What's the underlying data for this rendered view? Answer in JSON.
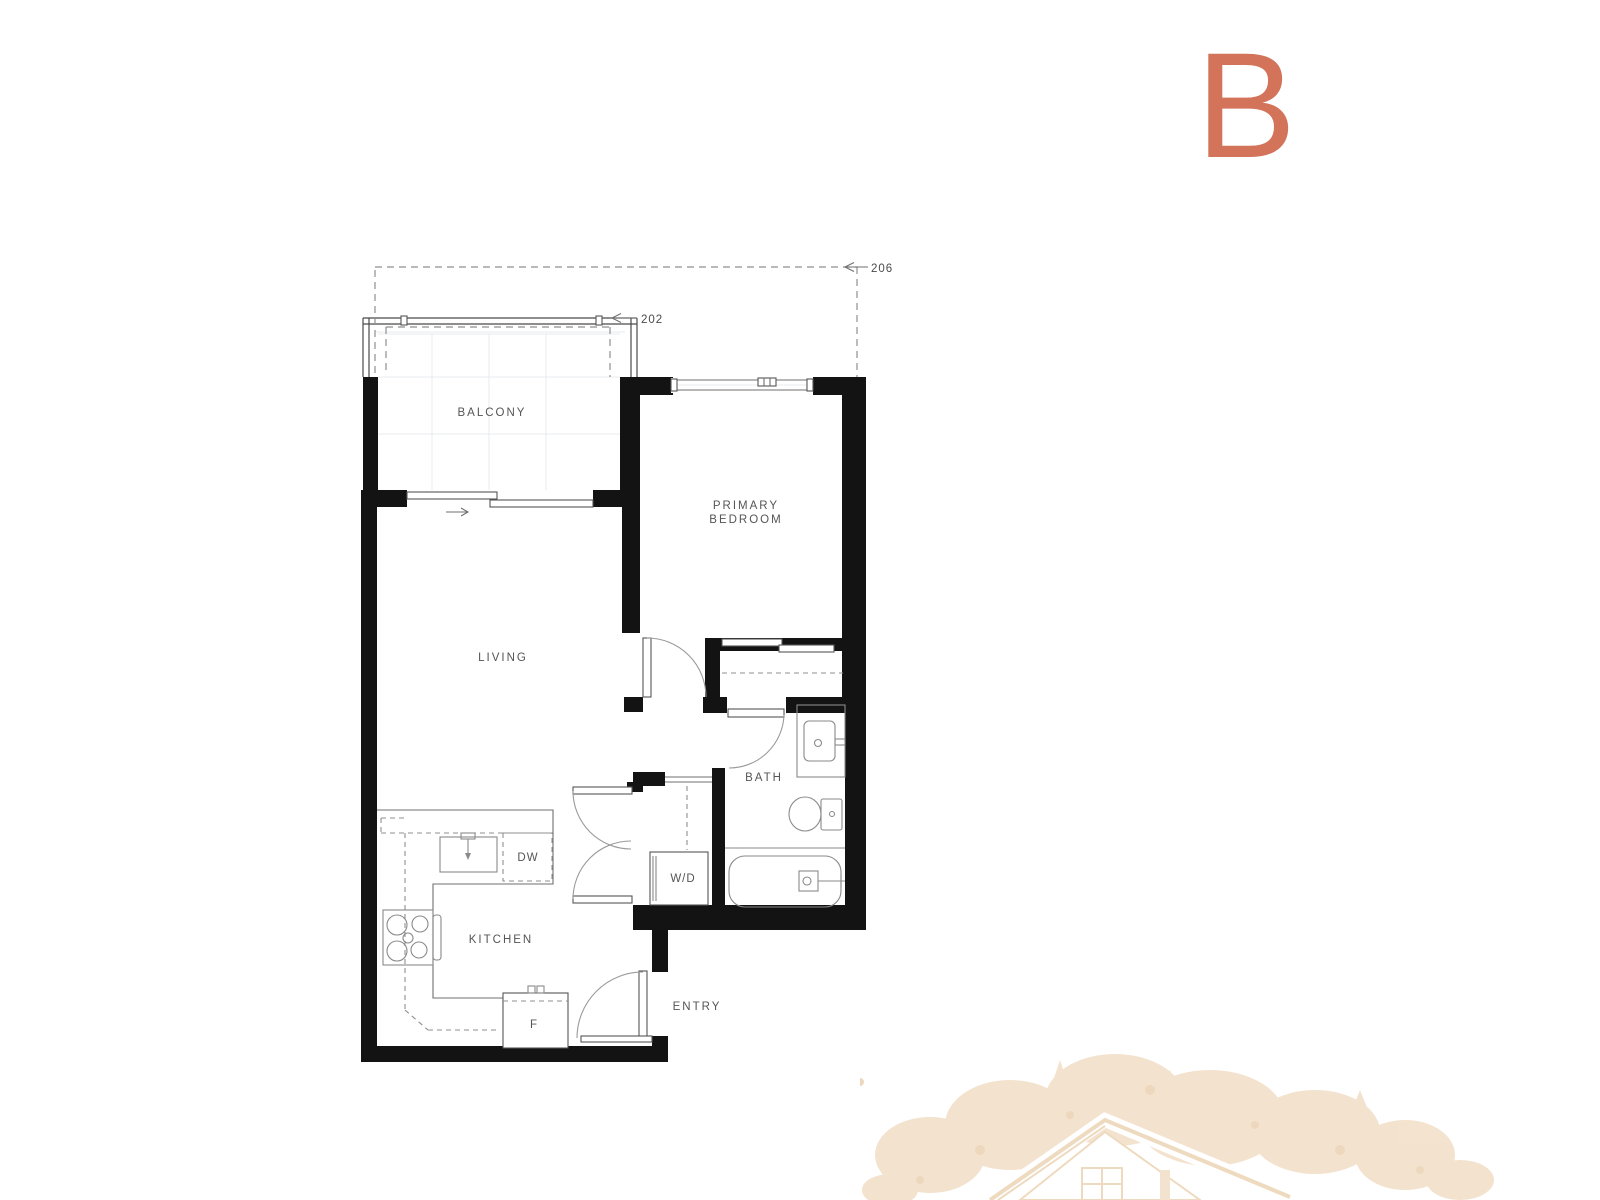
{
  "unit": {
    "plan_letter": "B"
  },
  "rooms": {
    "balcony": "BALCONY",
    "primary_bedroom": [
      "PRIMARY",
      "BEDROOM"
    ],
    "living": "LIVING",
    "bath": "BATH",
    "kitchen": "KITCHEN",
    "entry": "ENTRY"
  },
  "appliance_labels": {
    "dishwasher": "DW",
    "washer_dryer": "W/D",
    "fridge": "F"
  },
  "dimension_labels": {
    "overall": "206",
    "balcony": "202"
  },
  "colors": {
    "plan_letter": "#d2735a",
    "wall": "#131313",
    "line": "#6f6f6f",
    "text": "#555555",
    "watermark": "#f1dcc2"
  }
}
